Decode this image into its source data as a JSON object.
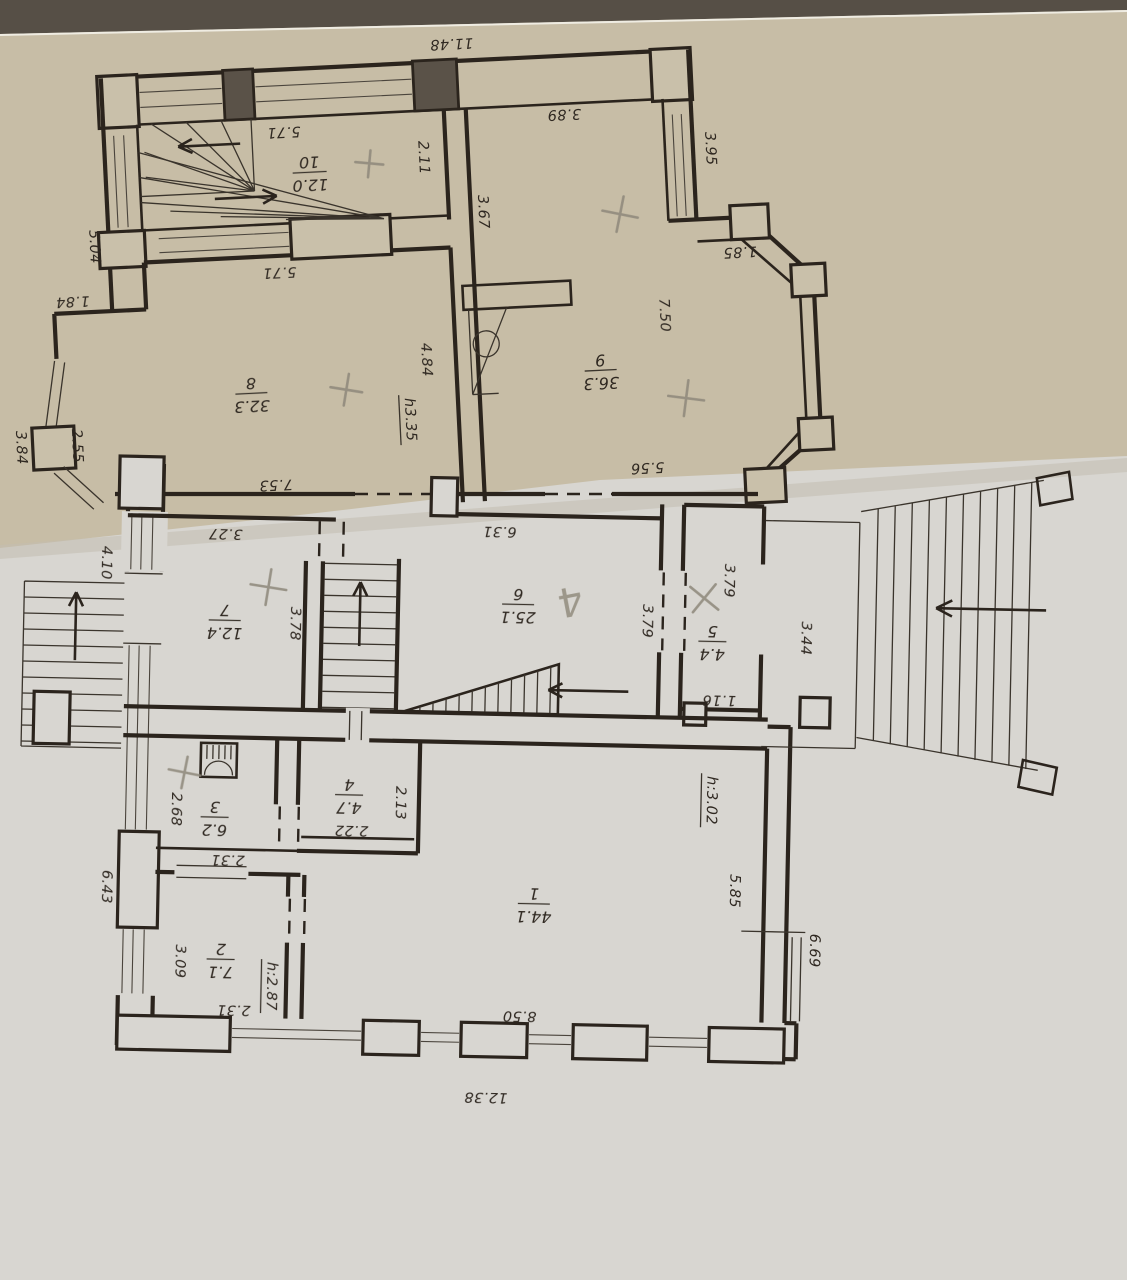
{
  "plan": {
    "kind": "scanned two-level floor plan",
    "pencil_note": "4"
  },
  "rooms": [
    {
      "num": "1",
      "area": "44.1"
    },
    {
      "num": "2",
      "area": "7.1"
    },
    {
      "num": "3",
      "area": "6.2"
    },
    {
      "num": "4",
      "area": "4.7"
    },
    {
      "num": "5",
      "area": "4.4"
    },
    {
      "num": "6",
      "area": "25.1"
    },
    {
      "num": "7",
      "area": "12.4"
    },
    {
      "num": "8",
      "area": "32.3"
    },
    {
      "num": "9",
      "area": "36.3"
    },
    {
      "num": "10",
      "area": "12.0"
    }
  ],
  "dims": {
    "d11_48": "11.48",
    "d5_71_room10": "5.71",
    "d2_11": "2.11",
    "d3_89": "3.89",
    "d3_95": "3.95",
    "d1_85": "1.85",
    "d3_67": "3.67",
    "d7_50": "7.50",
    "d5_04": "5.04",
    "d5_71_room8": "5.71",
    "d1_84": "1.84",
    "d3_84": "3.84",
    "d2_55": "2.55",
    "d4_84": "4.84",
    "h3_35": "h3.35",
    "d7_53": "7.53",
    "d5_56": "5.56",
    "d3_27": "3.27",
    "d6_31": "6.31",
    "d4_10": "4.10",
    "d3_78": "3.78",
    "d3_79_left": "3.79",
    "d3_79_right": "3.79",
    "d3_44": "3.44",
    "d1_16": "1.16",
    "d2_68": "2.68",
    "d2_31_room3": "2.31",
    "d2_22": "2.22",
    "d2_13": "2.13",
    "d6_43": "6.43",
    "d3_09": "3.09",
    "d2_31_room2": "2.31",
    "h2_87": "h:2.87",
    "h3_02": "h:3.02",
    "d5_85": "5.85",
    "d6_69": "6.69",
    "d8_50": "8.50",
    "d12_38": "12.38"
  }
}
